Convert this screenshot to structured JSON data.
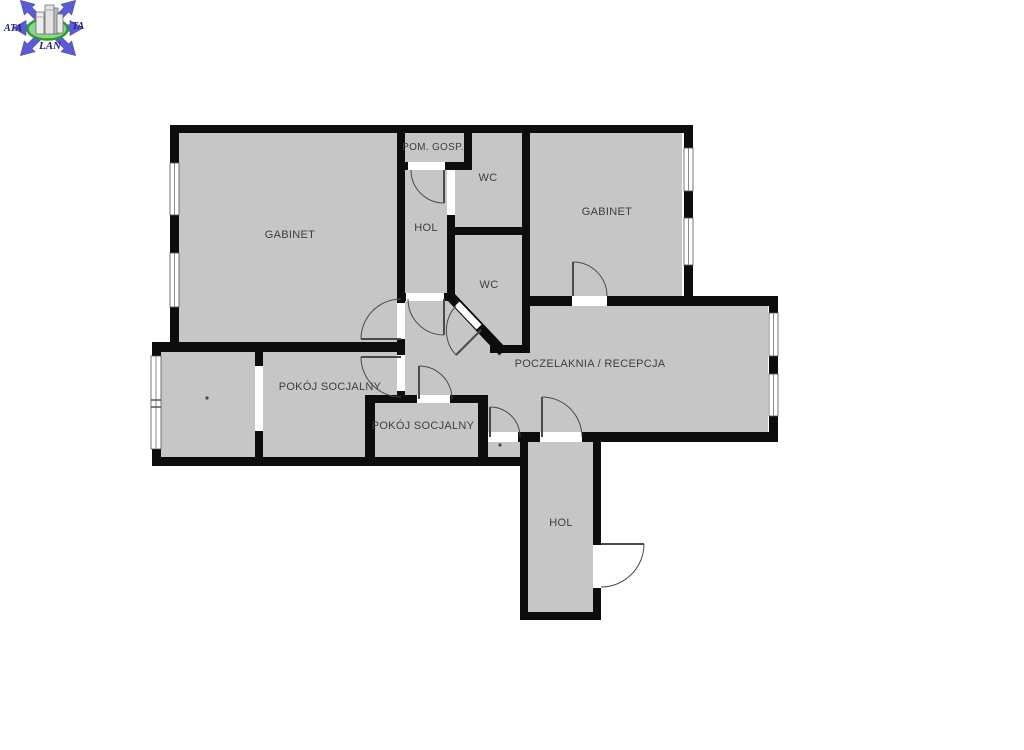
{
  "page": {
    "background": "#ffffff"
  },
  "colors": {
    "wall": "#0d0d0d",
    "room_fill": "#c6c6c6",
    "label_text": "#3e3e3e",
    "door_line": "#4a4a4a",
    "window_line": "#8a8a8a",
    "logo_arrow_blue": "#5b5bd3",
    "logo_green_stroke": "#2d9a2d",
    "logo_green_fill": "#8fd48f",
    "logo_text_color": "#23236e",
    "building_fill": "#ededed"
  },
  "logo": {
    "text_left": "ATA",
    "text_right": "TA",
    "text_bottom": "LAN"
  },
  "rooms": {
    "gabinet_left": {
      "label": "GABINET"
    },
    "gabinet_right": {
      "label": "GABINET"
    },
    "pom_gosp": {
      "label": "POM. GOSP."
    },
    "wc_upper": {
      "label": "WC"
    },
    "wc_lower": {
      "label": "WC"
    },
    "hol_top": {
      "label": "HOL"
    },
    "reception": {
      "label": "POCZELAKNIA / RECEPCJA"
    },
    "pokoj_socjalny_1": {
      "label": "POKÓJ SOCJALNY"
    },
    "pokoj_socjalny_2": {
      "label": "POKÓJ SOCJALNY"
    },
    "hol_bottom": {
      "label": "HOL"
    }
  }
}
